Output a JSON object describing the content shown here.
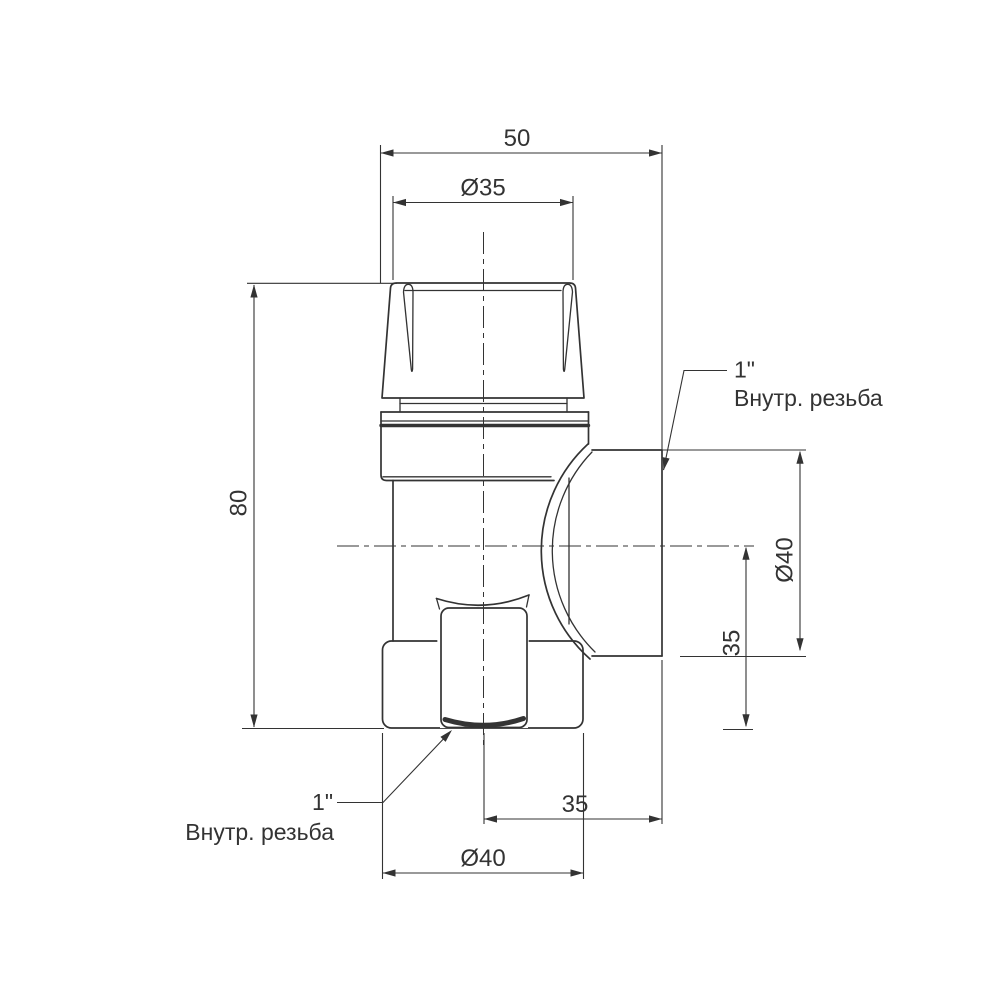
{
  "dims": {
    "width_top": "50",
    "cap_diameter": "Ø35",
    "height_left": "80",
    "side_port_diameter": "Ø40",
    "side_axis_height": "35",
    "side_port_offset": "35",
    "bottom_port_diameter": "Ø40"
  },
  "thread_labels": {
    "side_size": "1\"",
    "side_text": "Внутр. резьба",
    "bottom_size": "1\"",
    "bottom_text": "Внутр. резьба"
  },
  "colors": {
    "line_color": "#333333",
    "background": "#ffffff"
  }
}
